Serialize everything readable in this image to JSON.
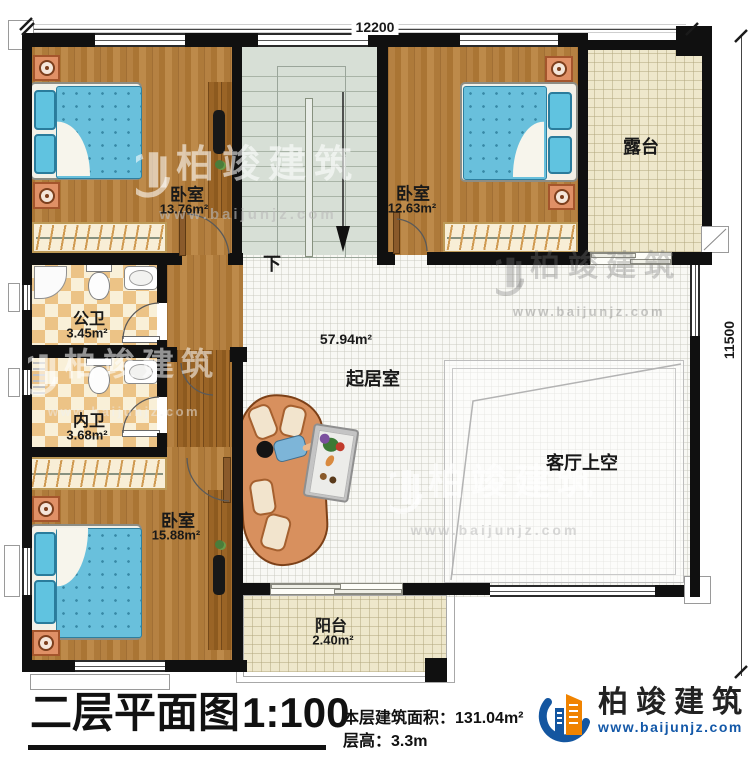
{
  "dimensions": {
    "top": "12200",
    "right": "11500"
  },
  "rooms": {
    "bedroom_tl": {
      "name": "卧室",
      "area": "13.76m²"
    },
    "bedroom_tr": {
      "name": "卧室",
      "area": "12.63m²"
    },
    "terrace": {
      "name": "露台"
    },
    "public_bath": {
      "name": "公卫",
      "area": "3.45m²"
    },
    "inner_bath": {
      "name": "内卫",
      "area": "3.68m²"
    },
    "bedroom_bl": {
      "name": "卧室",
      "area": "15.88m²"
    },
    "living": {
      "name": "起居室",
      "area": "57.94m²"
    },
    "void": {
      "name": "客厅上空"
    },
    "balcony": {
      "name": "阳台",
      "area": "2.40m²"
    }
  },
  "stairs": {
    "down_label": "下"
  },
  "title_block": {
    "title": "二层平面图",
    "scale": "1:100",
    "floor_area_label": "本层建筑面积：",
    "floor_area_value": "131.04m²",
    "floor_height_label": "层高：",
    "floor_height_value": "3.3m"
  },
  "brand": {
    "company": "柏竣建筑",
    "website": "www.baijunjz.com"
  },
  "watermark": {
    "text": "柏竣建筑",
    "website": "www.baijunjz.com"
  },
  "colors": {
    "wall": "#111111",
    "wood_floor": "#b28043",
    "bed_blue": "#69c0dc",
    "tile_beige": "#eee7cb",
    "checker_tan": "#ecc386",
    "brand_blue": "#1456a0",
    "brand_orange": "#f08300"
  }
}
